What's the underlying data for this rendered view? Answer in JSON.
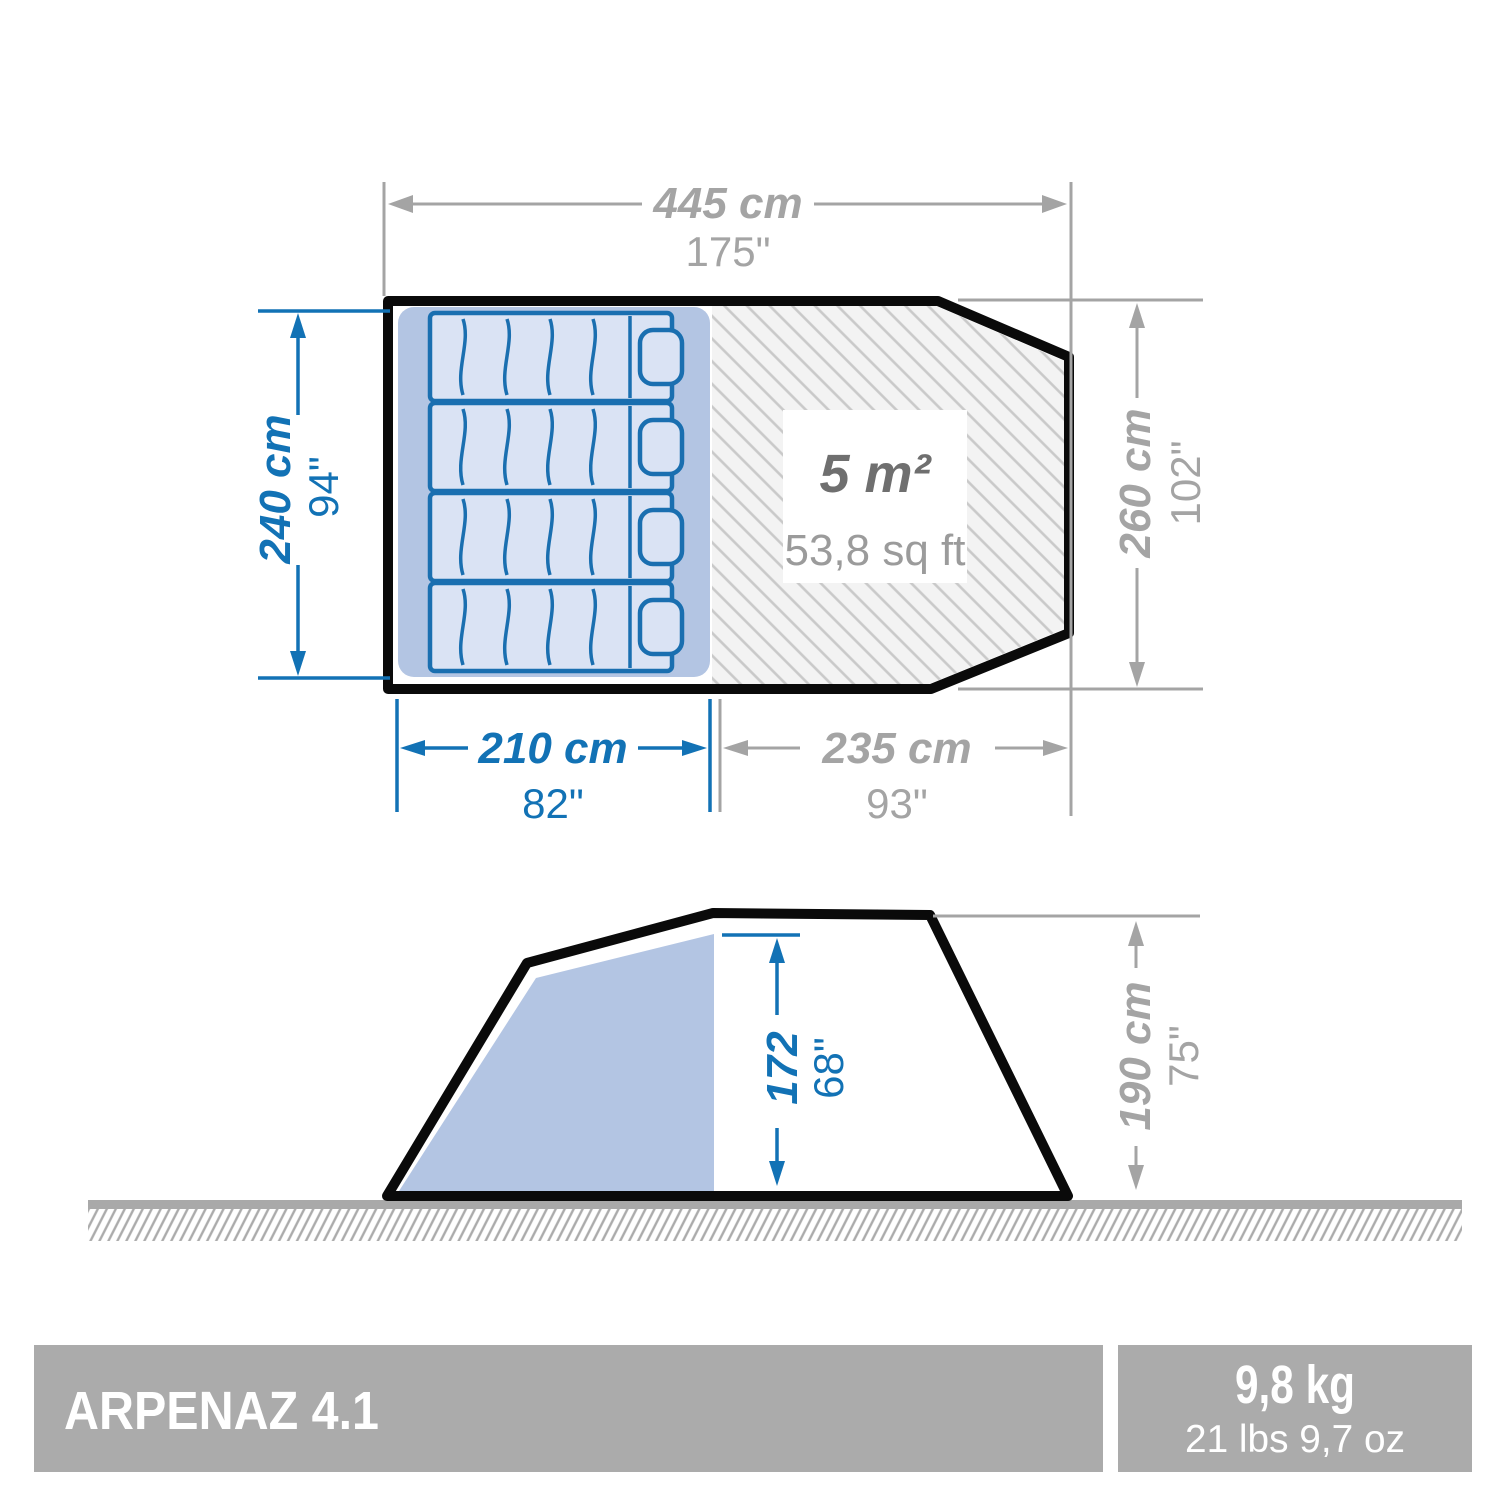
{
  "colors": {
    "accent_blue": "#1272b5",
    "dimension_gray": "#a4a4a4",
    "outline_black": "#0a0a0a",
    "sleeping_area_fill": "#b3c5e3",
    "mattress_fill": "#dae3f4",
    "hatch_background": "#f3f3f3",
    "footer_bar_gray": "#ababab",
    "area_label_dark": "#6f6f6f",
    "area_label_light": "#9b9b9b"
  },
  "top_view": {
    "total_width": {
      "cm": "445 cm",
      "in": "175\""
    },
    "sleeping_depth": {
      "cm": "240 cm",
      "in": "94\""
    },
    "max_depth": {
      "cm": "260 cm",
      "in": "102\""
    },
    "sleeping_width": {
      "cm": "210 cm",
      "in": "82\""
    },
    "living_width": {
      "cm": "235 cm",
      "in": "93\""
    },
    "living_area": {
      "m2": "5 m²",
      "sqft": "53,8 sq ft"
    },
    "bed_count": 4
  },
  "side_view": {
    "interior_height": {
      "cm": "172",
      "in": "68\""
    },
    "exterior_height": {
      "cm": "190 cm",
      "in": "75\""
    }
  },
  "footer": {
    "model": "ARPENAZ 4.1",
    "weight_metric": "9,8 kg",
    "weight_imperial": "21 lbs 9,7 oz"
  }
}
